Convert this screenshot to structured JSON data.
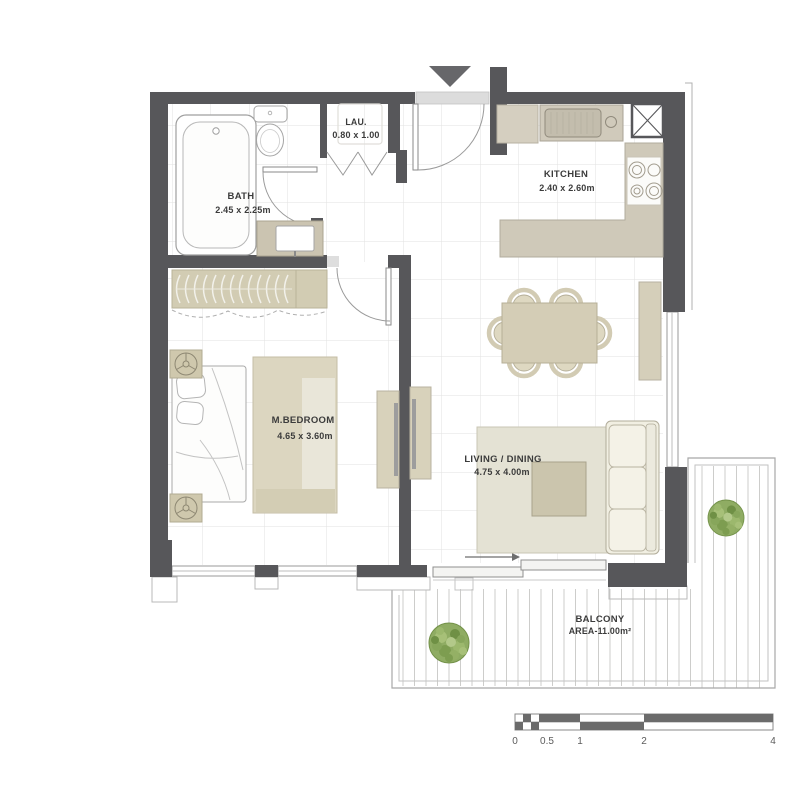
{
  "plan": {
    "rooms": [
      {
        "id": "bath",
        "name": "BATH",
        "dimensions": "2.45 x 2.25m"
      },
      {
        "id": "laundry",
        "name": "LAU.",
        "dimensions": "0.80 x 1.00"
      },
      {
        "id": "kitchen",
        "name": "KITCHEN",
        "dimensions": "2.40 x 2.60m"
      },
      {
        "id": "master_bedroom",
        "name": "M.BEDROOM",
        "dimensions": "4.65 x 3.60m"
      },
      {
        "id": "living_dining",
        "name": "LIVING / DINING",
        "dimensions": "4.75 x 4.00m"
      },
      {
        "id": "balcony",
        "name": "BALCONY",
        "dimensions": "AREA-11.00m²"
      }
    ],
    "scale_bar": {
      "labels": [
        "0",
        "0.5",
        "1",
        "2",
        "4"
      ]
    },
    "colors": {
      "wall": "#57575a",
      "furniture_beige": "#d3ccb5",
      "counter": "#cfc9b9",
      "rug": "#e4e2d4",
      "sofa_cream": "#f1efe2",
      "plant_green": "#86a55c",
      "floor_grid": "#e2e2e0",
      "threshold": "#dcdcdc"
    }
  }
}
